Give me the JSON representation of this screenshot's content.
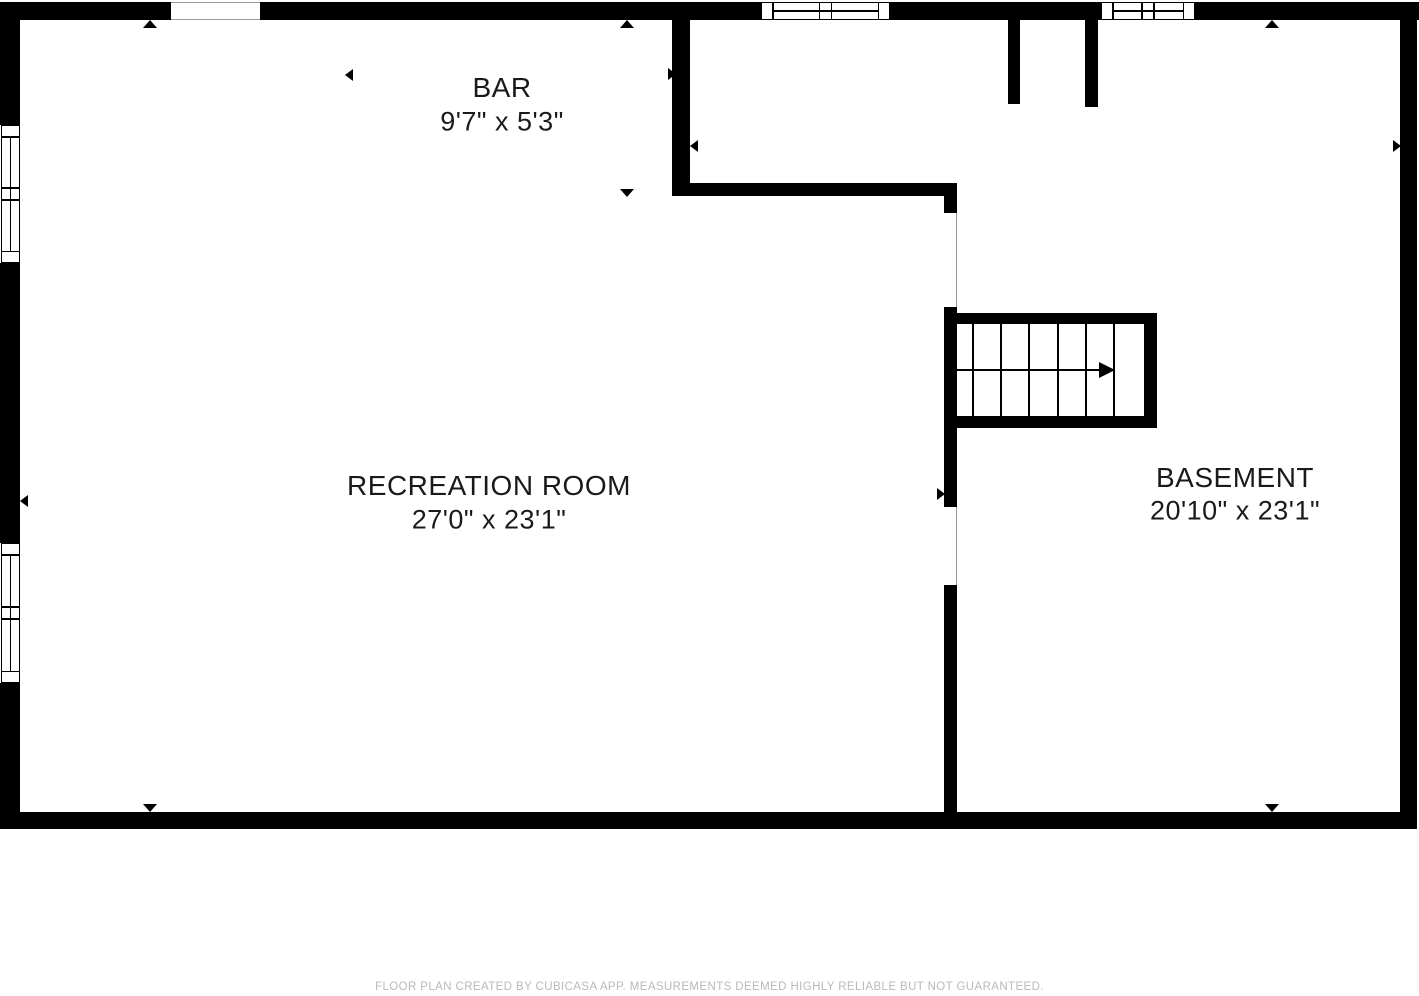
{
  "colors": {
    "wall": "#000000",
    "background": "#ffffff",
    "text": "#1a1a1a",
    "footer_text": "#b9b9b9",
    "opening_line": "#9a9a9a"
  },
  "rooms": [
    {
      "id": "bar",
      "name": "BAR",
      "dimensions": "9'7\" x 5'3\"",
      "cx": 502,
      "name_cy": 88,
      "dims_cy": 122
    },
    {
      "id": "recreation-room",
      "name": "RECREATION ROOM",
      "dimensions": "27'0\" x 23'1\"",
      "cx": 489,
      "name_cy": 486,
      "dims_cy": 520
    },
    {
      "id": "basement",
      "name": "BASEMENT",
      "dimensions": "20'10\" x 23'1\"",
      "cx": 1235,
      "name_cy": 478,
      "dims_cy": 511
    }
  ],
  "plan": {
    "walls": [
      {
        "id": "top-wall-a",
        "x": 0,
        "y": 2,
        "w": 171,
        "h": 18
      },
      {
        "id": "top-wall-b",
        "x": 260,
        "y": 2,
        "w": 501,
        "h": 18
      },
      {
        "id": "top-wall-c",
        "x": 890,
        "y": 2,
        "w": 211,
        "h": 18
      },
      {
        "id": "top-wall-d",
        "x": 1195,
        "y": 2,
        "w": 224,
        "h": 18
      },
      {
        "id": "left-wall-upper",
        "x": 0,
        "y": 2,
        "w": 20,
        "h": 123
      },
      {
        "id": "left-wall-mid",
        "x": 0,
        "y": 263,
        "w": 20,
        "h": 280
      },
      {
        "id": "left-wall-lower",
        "x": 0,
        "y": 683,
        "w": 20,
        "h": 146
      },
      {
        "id": "right-wall",
        "x": 1400,
        "y": 2,
        "w": 17,
        "h": 827
      },
      {
        "id": "bottom-wall",
        "x": 0,
        "y": 812,
        "w": 1415,
        "h": 17
      },
      {
        "id": "bar-right-wall",
        "x": 672,
        "y": 20,
        "w": 18,
        "h": 176
      },
      {
        "id": "bar-bottom-wall",
        "x": 672,
        "y": 183,
        "w": 285,
        "h": 13
      },
      {
        "id": "divider-tab",
        "x": 944,
        "y": 183,
        "w": 13,
        "h": 30
      },
      {
        "id": "divider-seg-stairs",
        "x": 944,
        "y": 307,
        "w": 13,
        "h": 121
      },
      {
        "id": "divider-seg-below-stairs",
        "x": 944,
        "y": 428,
        "w": 13,
        "h": 79
      },
      {
        "id": "divider-seg-lower",
        "x": 944,
        "y": 585,
        "w": 13,
        "h": 244
      },
      {
        "id": "entry-stub-left",
        "x": 1008,
        "y": 18,
        "w": 12,
        "h": 86
      },
      {
        "id": "entry-stub-right",
        "x": 1085,
        "y": 18,
        "w": 13,
        "h": 89
      },
      {
        "id": "stair-top-bar",
        "x": 944,
        "y": 313,
        "w": 213,
        "h": 11
      },
      {
        "id": "stair-right-bar",
        "x": 1144,
        "y": 313,
        "w": 13,
        "h": 115
      },
      {
        "id": "stair-bottom-bar",
        "x": 944,
        "y": 416,
        "w": 213,
        "h": 12
      }
    ],
    "openings": [
      {
        "id": "top-wall-opening",
        "x": 171,
        "y": 2,
        "w": 89,
        "h": 18,
        "orientation": "h"
      },
      {
        "id": "divider-doorway-upper",
        "x": 944,
        "y": 213,
        "w": 13,
        "h": 94,
        "orientation": "v"
      },
      {
        "id": "divider-doorway-lower",
        "x": 944,
        "y": 507,
        "w": 13,
        "h": 78,
        "orientation": "v"
      }
    ],
    "windows": [
      {
        "id": "top-window-1",
        "x": 761,
        "y": 2,
        "w": 129,
        "h": 18,
        "orientation": "h"
      },
      {
        "id": "top-window-2",
        "x": 1101,
        "y": 2,
        "w": 94,
        "h": 18,
        "orientation": "h"
      },
      {
        "id": "left-window-1",
        "x": 1,
        "y": 125,
        "w": 19,
        "h": 138,
        "orientation": "v"
      },
      {
        "id": "left-window-2",
        "x": 1,
        "y": 543,
        "w": 19,
        "h": 140,
        "orientation": "v"
      }
    ],
    "stairs": {
      "region": {
        "x": 957,
        "y": 324,
        "w": 187,
        "h": 92
      },
      "tread_xs": [
        972,
        1000,
        1028,
        1057,
        1085,
        1113
      ],
      "arrow": {
        "shaft_x": 957,
        "shaft_len": 143,
        "y": 370,
        "tip_x": 1115
      }
    },
    "markers": [
      {
        "dir": "up",
        "x": 150,
        "y": 20
      },
      {
        "dir": "up",
        "x": 627,
        "y": 20
      },
      {
        "dir": "up",
        "x": 1272,
        "y": 20
      },
      {
        "dir": "down",
        "x": 150,
        "y": 812
      },
      {
        "dir": "down",
        "x": 627,
        "y": 197
      },
      {
        "dir": "down",
        "x": 1272,
        "y": 812
      },
      {
        "dir": "left",
        "x": 345,
        "y": 75
      },
      {
        "dir": "right",
        "x": 676,
        "y": 74
      },
      {
        "dir": "left",
        "x": 690,
        "y": 146
      },
      {
        "dir": "right",
        "x": 1401,
        "y": 146
      },
      {
        "dir": "left",
        "x": 20,
        "y": 501
      },
      {
        "dir": "right",
        "x": 945,
        "y": 494
      }
    ]
  },
  "footer": {
    "text": "FLOOR PLAN CREATED BY CUBICASA APP. MEASUREMENTS DEEMED HIGHLY RELIABLE BUT NOT GUARANTEED.",
    "y": 981
  }
}
